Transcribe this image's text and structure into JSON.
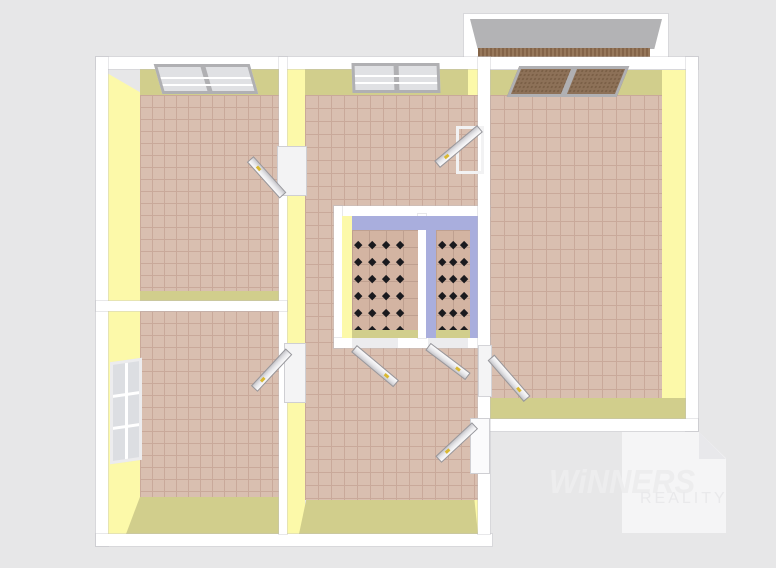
{
  "watermark": {
    "brand": "WiNNERS",
    "subtitle": "REALITY"
  },
  "pattern": {
    "diamond_glyph": "◆"
  },
  "colors": {
    "background": "#e7e7e8",
    "wall_white": "#ffffff",
    "wall_yellow": "#fcf9a9",
    "wall_olive": "#d1ce8c",
    "wall_periwinkle": "#a9aedd",
    "floor_tile": "#d9bfb0",
    "floor_grout": "#c9a99a",
    "bath_floor": "#d3b4a2",
    "bath_grout": "#bfa090",
    "diamond": "#1a1a1e",
    "balcony_wall": "#b3b3b5",
    "balcony_floor": "#8f6f52",
    "window_frame": "#b0b0b3",
    "window_glass": "#e0e1e4",
    "window_glass_brown": "#8d7158",
    "door_handle": "#d9b832",
    "watermark_text": "#ededee",
    "watermark_box": "#f5f5f6"
  }
}
